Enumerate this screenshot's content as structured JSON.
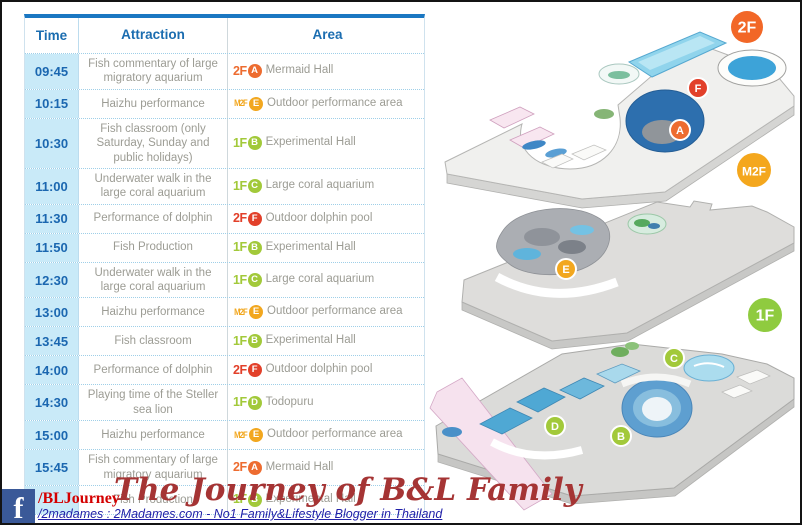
{
  "schedule_table": {
    "columns": [
      "Time",
      "Attraction",
      "Area"
    ],
    "rows": [
      {
        "time": "09:45",
        "attraction": "Fish commentary of large migratory aquarium",
        "floor": "2F",
        "marker": "A",
        "area": "Mermaid Hall",
        "badge_color": "#ed6c30"
      },
      {
        "time": "10:15",
        "attraction": "Haizhu performance",
        "floor": "M2F",
        "marker": "E",
        "area": "Outdoor performance area",
        "badge_color": "#f2a71f"
      },
      {
        "time": "10:30",
        "attraction": "Fish classroom (only Saturday, Sunday and public holidays)",
        "floor": "1F",
        "marker": "B",
        "area": "Experimental Hall",
        "badge_color": "#a2c93a"
      },
      {
        "time": "11:00",
        "attraction": "Underwater walk in the large coral aquarium",
        "floor": "1F",
        "marker": "C",
        "area": "Large coral aquarium",
        "badge_color": "#a2c93a"
      },
      {
        "time": "11:30",
        "attraction": "Performance of dolphin",
        "floor": "2F",
        "marker": "F",
        "area": "Outdoor dolphin pool",
        "badge_color": "#e2402a"
      },
      {
        "time": "11:50",
        "attraction": "Fish Production",
        "floor": "1F",
        "marker": "B",
        "area": "Experimental Hall",
        "badge_color": "#a2c93a"
      },
      {
        "time": "12:30",
        "attraction": "Underwater walk in the large coral aquarium",
        "floor": "1F",
        "marker": "C",
        "area": "Large coral aquarium",
        "badge_color": "#a2c93a"
      },
      {
        "time": "13:00",
        "attraction": "Haizhu performance",
        "floor": "M2F",
        "marker": "E",
        "area": "Outdoor performance area",
        "badge_color": "#f2a71f"
      },
      {
        "time": "13:45",
        "attraction": "Fish classroom",
        "floor": "1F",
        "marker": "B",
        "area": "Experimental Hall",
        "badge_color": "#a2c93a"
      },
      {
        "time": "14:00",
        "attraction": "Performance of dolphin",
        "floor": "2F",
        "marker": "F",
        "area": "Outdoor dolphin pool",
        "badge_color": "#e2402a"
      },
      {
        "time": "14:30",
        "attraction": "Playing time of the Steller sea lion",
        "floor": "1F",
        "marker": "D",
        "area": "Todopuru",
        "badge_color": "#a2c93a"
      },
      {
        "time": "15:00",
        "attraction": "Haizhu performance",
        "floor": "M2F",
        "marker": "E",
        "area": "Outdoor performance area",
        "badge_color": "#f2a71f"
      },
      {
        "time": "15:45",
        "attraction": "Fish commentary of large migratory aquarium",
        "floor": "2F",
        "marker": "A",
        "area": "Mermaid Hall",
        "badge_color": "#ed6c30"
      },
      {
        "time": "",
        "attraction": "Fish Production",
        "floor": "1F",
        "marker": "B",
        "area": "Experimental Hall",
        "badge_color": "#a2c93a"
      }
    ]
  },
  "maps": {
    "floors": [
      {
        "label": "2F",
        "badge_color": "#f26727",
        "badge_x": 325,
        "badge_y": 25,
        "badge_r": 16,
        "markers": [
          {
            "letter": "F",
            "color": "#e2402a",
            "x": 276,
            "y": 86
          },
          {
            "letter": "A",
            "color": "#ed6c30",
            "x": 258,
            "y": 128
          }
        ]
      },
      {
        "label": "M2F",
        "badge_color": "#f4a71d",
        "badge_x": 332,
        "badge_y": 168,
        "badge_r": 17,
        "markers": [
          {
            "letter": "E",
            "color": "#f2a71f",
            "x": 144,
            "y": 267
          }
        ]
      },
      {
        "label": "1F",
        "badge_color": "#8fcb3f",
        "badge_x": 343,
        "badge_y": 313,
        "badge_r": 17,
        "markers": [
          {
            "letter": "C",
            "color": "#a2c93a",
            "x": 252,
            "y": 356
          },
          {
            "letter": "D",
            "color": "#a2c93a",
            "x": 133,
            "y": 424
          },
          {
            "letter": "B",
            "color": "#a2c93a",
            "x": 199,
            "y": 434
          }
        ]
      }
    ]
  },
  "watermark": {
    "facebook_icon_letter": "f",
    "handle_red": "/BLJourney",
    "script_text": "The Journey of B&L Family",
    "handle_navy": "/2madames : 2Madames.com - No1 Family&Lifestyle Blogger in Thailand"
  }
}
